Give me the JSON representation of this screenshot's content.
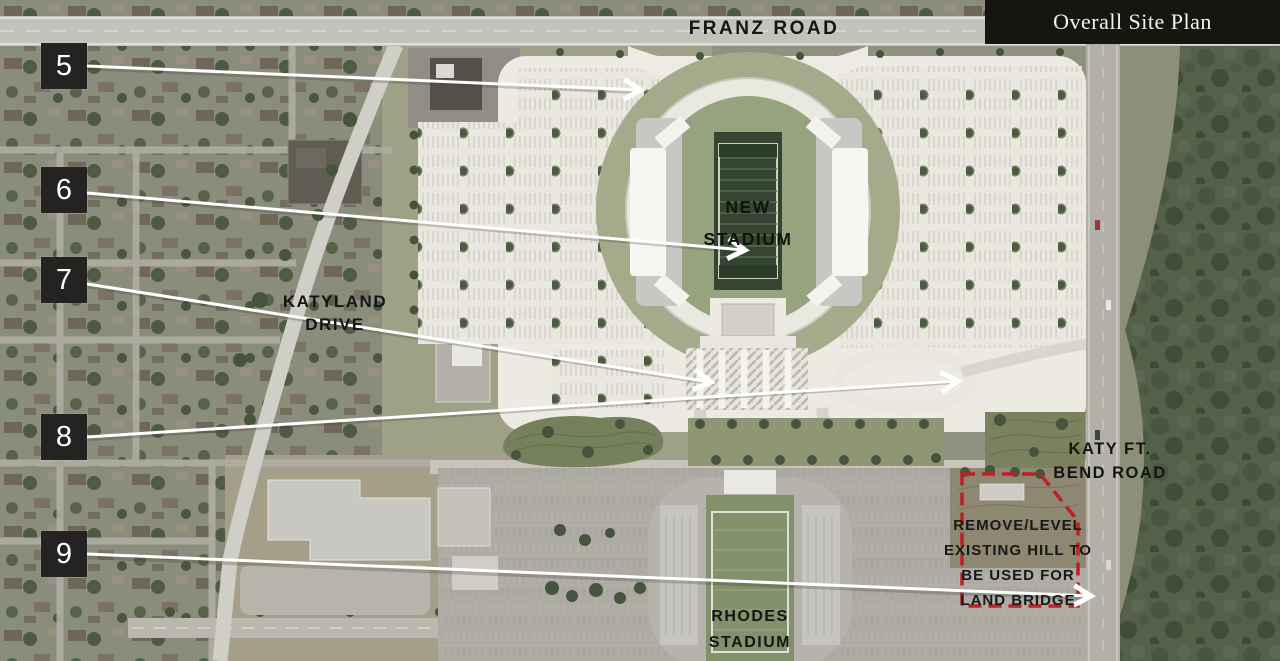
{
  "header": {
    "title": "Overall Site Plan"
  },
  "map_labels": {
    "franz_road": "FRANZ ROAD",
    "katyland_drive": "KATYLAND DRIVE",
    "new_stadium": "NEW STADIUM",
    "katy_ft_bend_road": "KATY FT. BEND ROAD",
    "rhodes_stadium": "RHODES STADIUM",
    "remove_hill_note": "REMOVE/LEVEL EXISTING HILL TO BE USED FOR LAND BRIDGE"
  },
  "callouts": [
    {
      "label": "5"
    },
    {
      "label": "6"
    },
    {
      "label": "7"
    },
    {
      "label": "8"
    },
    {
      "label": "9"
    }
  ],
  "icons": {
    "arrowhead": "chevron-right"
  },
  "colors": {
    "header_bg": "#16150f",
    "header_text": "#f4f3ef",
    "callout_bg": "#242322",
    "callout_text": "#ffffff",
    "arrow": "#ffffff",
    "annotation_red": "#bf2026",
    "map_label_text": "#141414",
    "site_plan_paving": "#e9e7df",
    "field_green": "#344631",
    "forest_green": "#54604a"
  }
}
